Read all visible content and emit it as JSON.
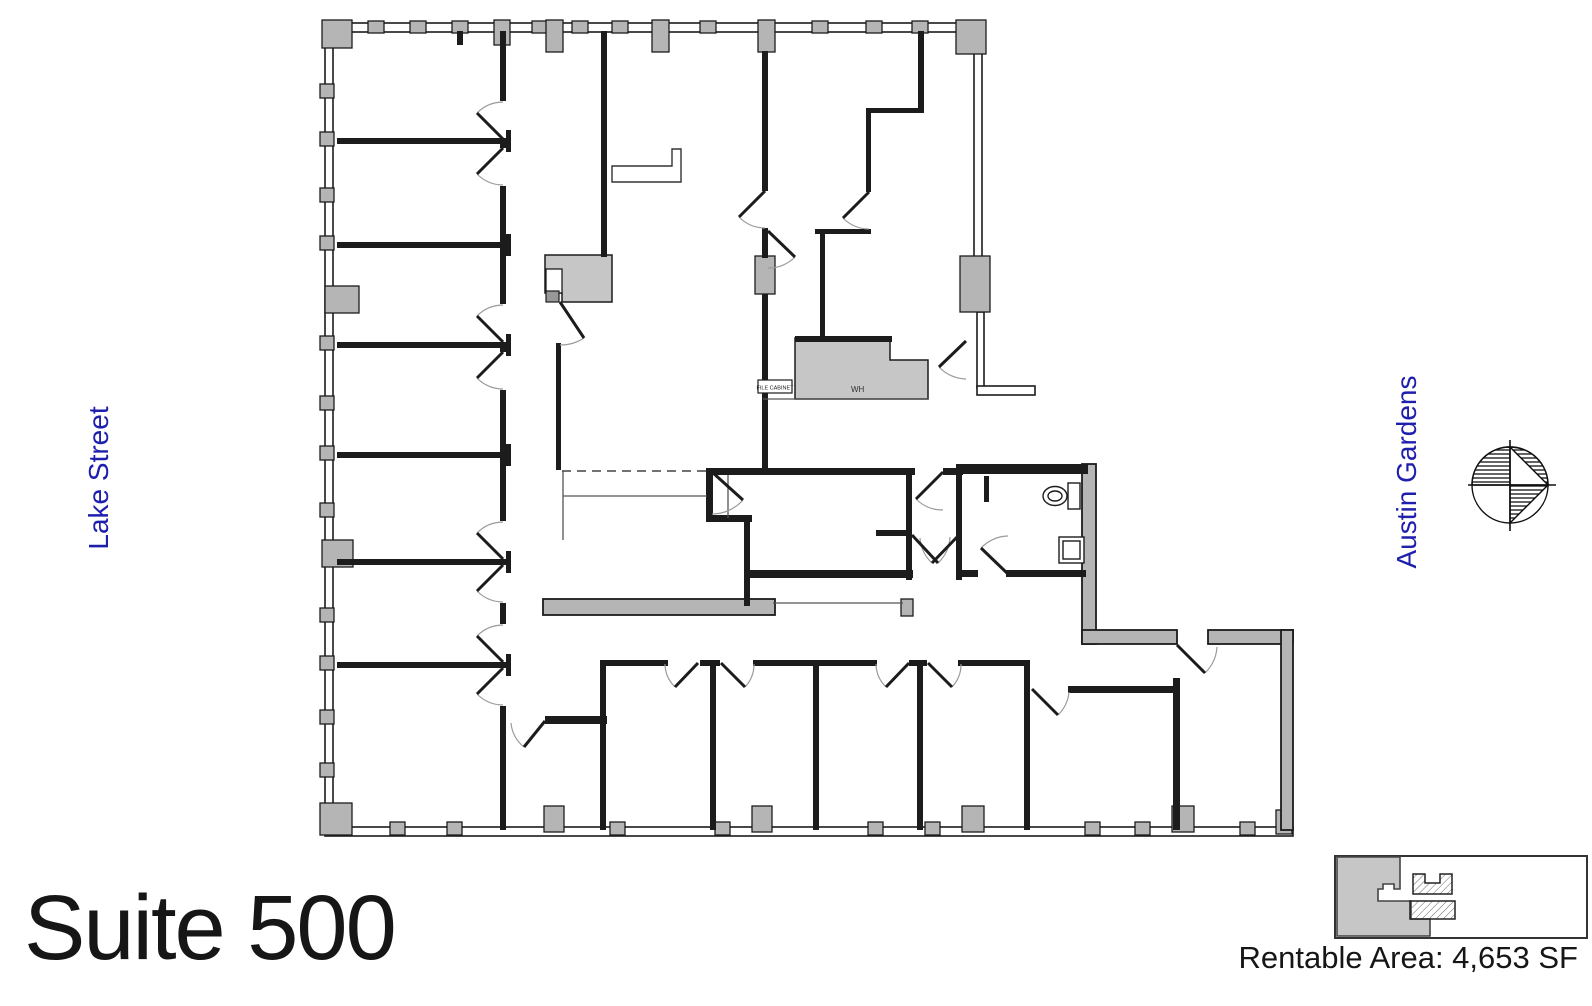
{
  "title": {
    "text": "Suite 500"
  },
  "area": {
    "text": "Rentable Area: 4,653 SF"
  },
  "streets": {
    "left": "Lake Street",
    "right": "Austin Gardens",
    "color": "#1f1fae"
  },
  "plan_labels": {
    "water_heater": "WH",
    "cabinet": "FILE CABINET"
  },
  "key_plan": {
    "description": "building footprint with suite highlighted",
    "suite_fill": "#c6c6c6"
  },
  "compass": {
    "name": "north-arrow"
  },
  "colors": {
    "wall": "#1c1c1c",
    "column": "#b5b5b5",
    "shaded_area": "#c6c6c6",
    "accent_blue": "#1f1fae",
    "background": "#ffffff"
  }
}
